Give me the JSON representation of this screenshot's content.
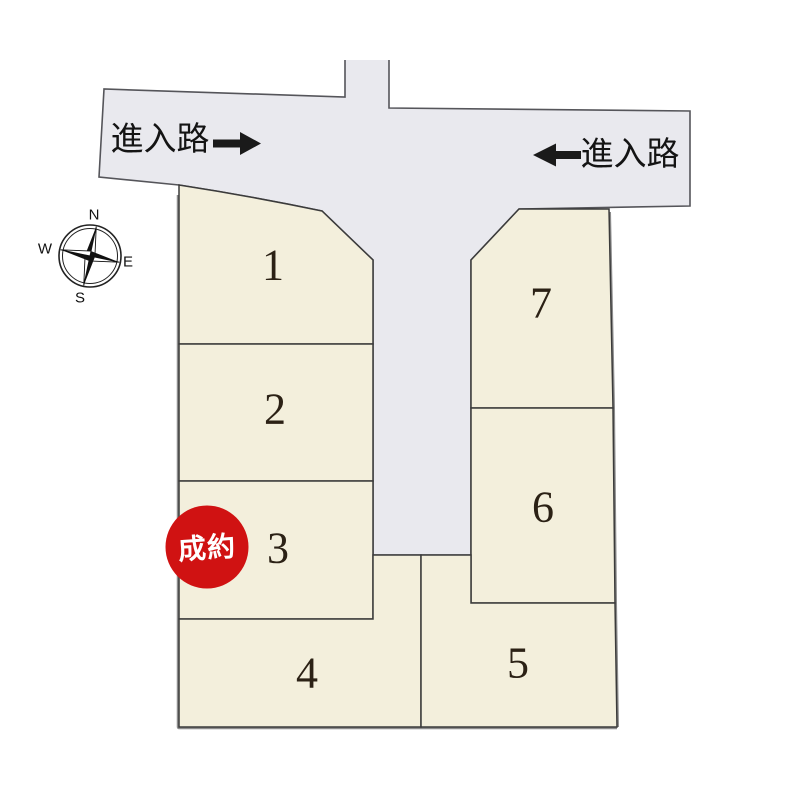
{
  "road": {
    "entry_label_left": "進入路",
    "entry_label_right": "進入路"
  },
  "compass": {
    "north": "N",
    "south": "S",
    "east": "E",
    "west": "W"
  },
  "badge": {
    "label": "成約"
  },
  "lots": [
    {
      "number": "1"
    },
    {
      "number": "2"
    },
    {
      "number": "3"
    },
    {
      "number": "4"
    },
    {
      "number": "5"
    },
    {
      "number": "6"
    },
    {
      "number": "7"
    }
  ],
  "colors": {
    "lot_fill": "#f3efdc",
    "road_fill": "#e9e9ee",
    "outline": "#3b3b3b",
    "outer_shadow": "#8d8d8d",
    "badge_red": "#d01212",
    "text_dark": "#2b2115"
  }
}
